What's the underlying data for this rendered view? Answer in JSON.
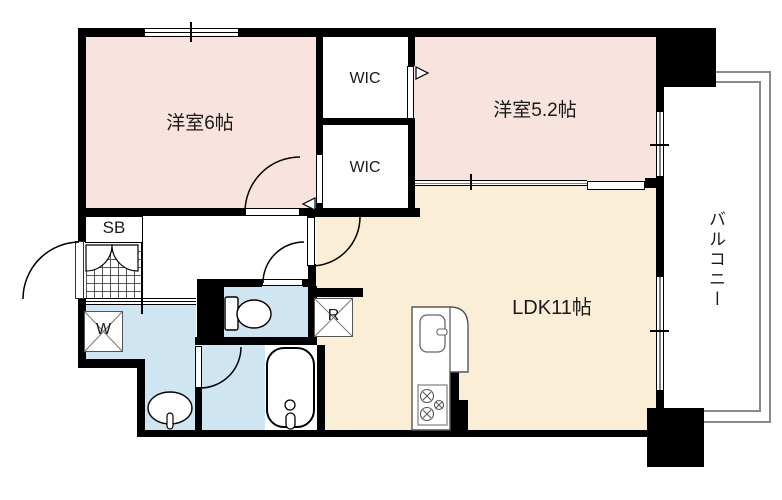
{
  "floorplan": {
    "rooms": {
      "bedroom6": {
        "label": "洋室6帖"
      },
      "bedroom52": {
        "label": "洋室5.2帖"
      },
      "ldk": {
        "label": "LDK11帖"
      },
      "wic_top": {
        "label": "WIC"
      },
      "wic_bottom": {
        "label": "WIC"
      },
      "balcony": {
        "label": "バルコニー"
      },
      "shoe_box": {
        "label": "SB"
      },
      "washing_machine": {
        "label": "W"
      },
      "refrigerator": {
        "label": "R"
      }
    },
    "colors": {
      "bedroom_fill": "#f8e3de",
      "ldk_fill": "#faeed6",
      "wet_area_fill": "#cfe5f2",
      "wall": "#000000",
      "balcony_outline": "#8a8a8a",
      "background": "#ffffff"
    }
  }
}
